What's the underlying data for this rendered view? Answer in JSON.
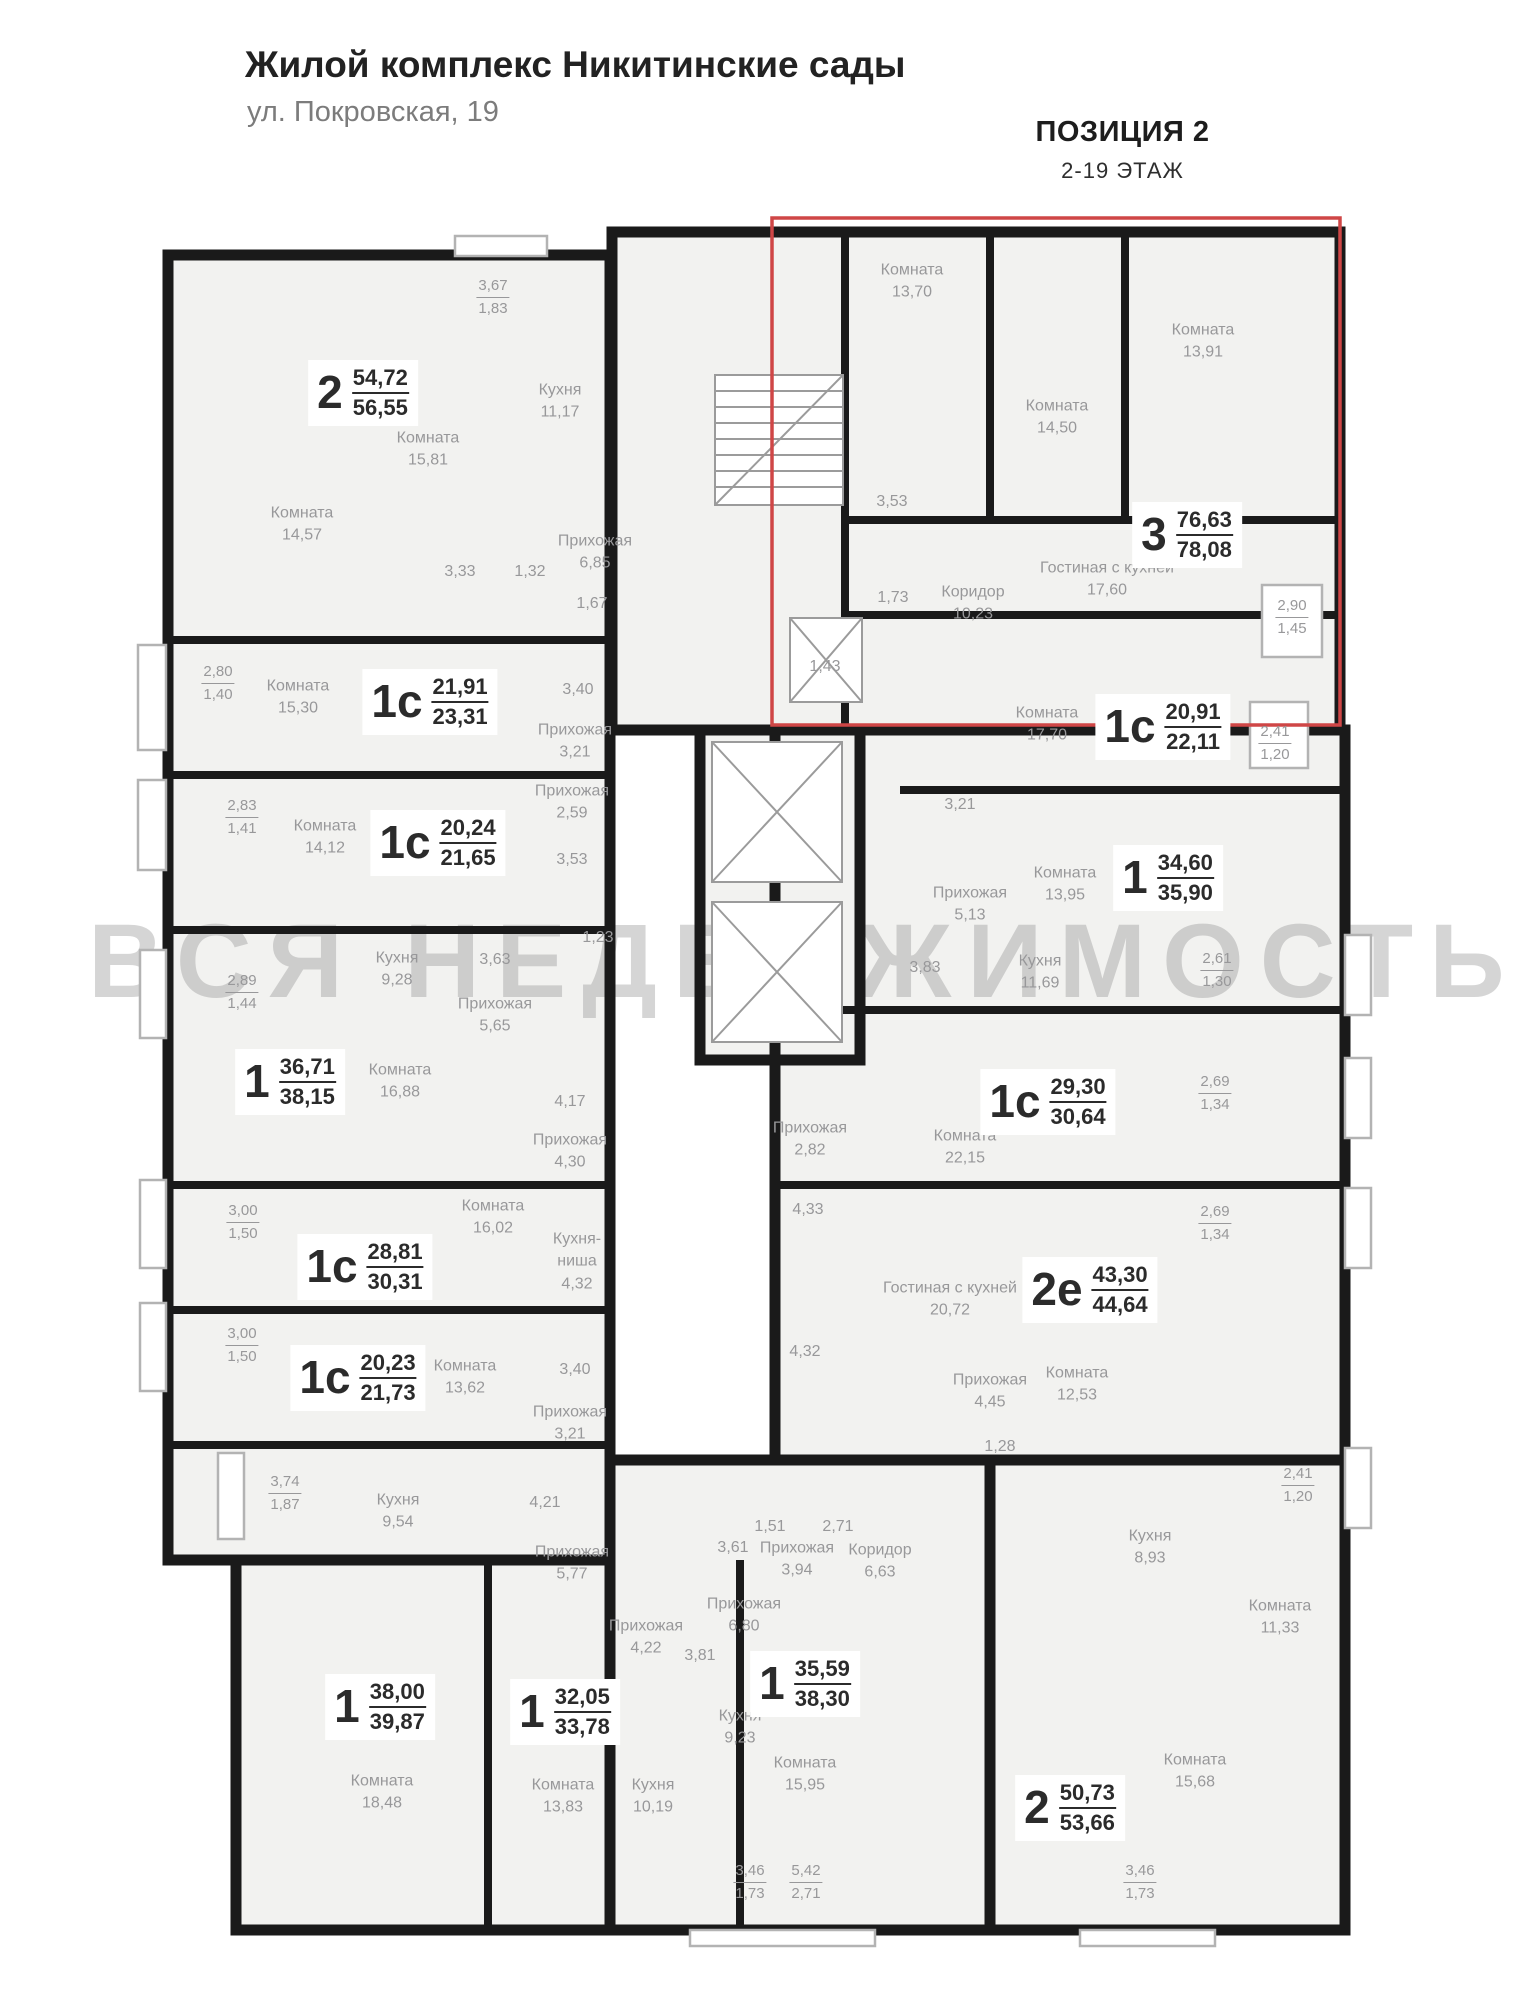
{
  "header": {
    "title": "Жилой комплекс Никитинские сады",
    "subtitle": "ул. Покровская, 19",
    "position_label": "ПОЗИЦИЯ 2",
    "floors_label": "2-19 ЭТАЖ"
  },
  "watermark": "ВСЯ НЕДВИЖИМОСТЬ",
  "colors": {
    "walls": "#1a1a1a",
    "room_fill": "#f2f2f0",
    "highlight": "#cf4646",
    "label_gray": "#98989a",
    "label_dark": "#2b2b2b",
    "watermark": "rgba(155,155,155,0.42)"
  },
  "highlight_box": {
    "x": 772,
    "y": 218,
    "w": 568,
    "h": 507
  },
  "apartments": [
    {
      "type": "2",
      "a": "54,72",
      "b": "56,55",
      "x": 363,
      "y": 393
    },
    {
      "type": "1с",
      "a": "21,91",
      "b": "23,31",
      "x": 430,
      "y": 702
    },
    {
      "type": "1с",
      "a": "20,24",
      "b": "21,65",
      "x": 438,
      "y": 843
    },
    {
      "type": "1",
      "a": "36,71",
      "b": "38,15",
      "x": 290,
      "y": 1082
    },
    {
      "type": "1с",
      "a": "28,81",
      "b": "30,31",
      "x": 365,
      "y": 1267
    },
    {
      "type": "1с",
      "a": "20,23",
      "b": "21,73",
      "x": 358,
      "y": 1378
    },
    {
      "type": "1",
      "a": "38,00",
      "b": "39,87",
      "x": 380,
      "y": 1707
    },
    {
      "type": "1",
      "a": "32,05",
      "b": "33,78",
      "x": 565,
      "y": 1712
    },
    {
      "type": "1",
      "a": "35,59",
      "b": "38,30",
      "x": 805,
      "y": 1684
    },
    {
      "type": "2",
      "a": "50,73",
      "b": "53,66",
      "x": 1070,
      "y": 1808
    },
    {
      "type": "3",
      "a": "76,63",
      "b": "78,08",
      "x": 1187,
      "y": 535
    },
    {
      "type": "1с",
      "a": "20,91",
      "b": "22,11",
      "x": 1163,
      "y": 727
    },
    {
      "type": "1",
      "a": "34,60",
      "b": "35,90",
      "x": 1168,
      "y": 878
    },
    {
      "type": "1с",
      "a": "29,30",
      "b": "30,64",
      "x": 1048,
      "y": 1102
    },
    {
      "type": "2е",
      "a": "43,30",
      "b": "44,64",
      "x": 1090,
      "y": 1290
    }
  ],
  "rooms": [
    {
      "name": "Комната",
      "area": "13,70",
      "x": 912,
      "y": 282
    },
    {
      "name": "Комната",
      "area": "14,50",
      "x": 1057,
      "y": 418
    },
    {
      "name": "Комната",
      "area": "13,91",
      "x": 1203,
      "y": 342
    },
    {
      "name": "Гостиная с кухней",
      "area": "17,60",
      "x": 1107,
      "y": 580
    },
    {
      "name": "Коридор",
      "area": "10,23",
      "x": 973,
      "y": 604
    },
    {
      "name": "",
      "area": "3,53",
      "x": 892,
      "y": 502
    },
    {
      "name": "",
      "area": "1,73",
      "x": 893,
      "y": 598
    },
    {
      "name": "",
      "area": "1,43",
      "x": 825,
      "y": 667
    },
    {
      "name": "Комната",
      "area": "17,70",
      "x": 1047,
      "y": 725
    },
    {
      "name": "Кухня",
      "area": "11,17",
      "x": 560,
      "y": 402
    },
    {
      "name": "Комната",
      "area": "15,81",
      "x": 428,
      "y": 450
    },
    {
      "name": "Комната",
      "area": "14,57",
      "x": 302,
      "y": 525
    },
    {
      "name": "Прихожая",
      "area": "6,85",
      "x": 595,
      "y": 553
    },
    {
      "name": "",
      "area": "3,33",
      "x": 460,
      "y": 572
    },
    {
      "name": "",
      "area": "1,32",
      "x": 530,
      "y": 572
    },
    {
      "name": "",
      "area": "1,67",
      "x": 592,
      "y": 604
    },
    {
      "name": "Комната",
      "area": "15,30",
      "x": 298,
      "y": 698
    },
    {
      "name": "",
      "area": "3,40",
      "x": 578,
      "y": 690
    },
    {
      "name": "Прихожая",
      "area": "3,21",
      "x": 575,
      "y": 742
    },
    {
      "name": "Комната",
      "area": "14,12",
      "x": 325,
      "y": 838
    },
    {
      "name": "Прихожая",
      "area": "2,59",
      "x": 572,
      "y": 803
    },
    {
      "name": "",
      "area": "3,53",
      "x": 572,
      "y": 860
    },
    {
      "name": "",
      "area": "1,23",
      "x": 598,
      "y": 938
    },
    {
      "name": "Кухня",
      "area": "9,28",
      "x": 397,
      "y": 970
    },
    {
      "name": "",
      "area": "3,63",
      "x": 495,
      "y": 960
    },
    {
      "name": "Прихожая",
      "area": "5,65",
      "x": 495,
      "y": 1016
    },
    {
      "name": "Комната",
      "area": "16,88",
      "x": 400,
      "y": 1082
    },
    {
      "name": "",
      "area": "4,17",
      "x": 570,
      "y": 1102
    },
    {
      "name": "Прихожая",
      "area": "4,30",
      "x": 570,
      "y": 1152
    },
    {
      "name": "Комната",
      "area": "16,02",
      "x": 493,
      "y": 1218
    },
    {
      "name": "Кухня-\nниша",
      "area": "4,32",
      "x": 577,
      "y": 1262
    },
    {
      "name": "Комната",
      "area": "13,62",
      "x": 465,
      "y": 1378
    },
    {
      "name": "",
      "area": "3,40",
      "x": 575,
      "y": 1370
    },
    {
      "name": "Прихожая",
      "area": "3,21",
      "x": 570,
      "y": 1424
    },
    {
      "name": "Кухня",
      "area": "9,54",
      "x": 398,
      "y": 1512
    },
    {
      "name": "",
      "area": "4,21",
      "x": 545,
      "y": 1503
    },
    {
      "name": "Прихожая",
      "area": "5,77",
      "x": 572,
      "y": 1564
    },
    {
      "name": "Комната",
      "area": "18,48",
      "x": 382,
      "y": 1793
    },
    {
      "name": "Комната",
      "area": "13,83",
      "x": 563,
      "y": 1797
    },
    {
      "name": "Прихожая",
      "area": "4,22",
      "x": 646,
      "y": 1638
    },
    {
      "name": "",
      "area": "3,81",
      "x": 700,
      "y": 1656
    },
    {
      "name": "Кухня",
      "area": "10,19",
      "x": 653,
      "y": 1797
    },
    {
      "name": "",
      "area": "3,61",
      "x": 733,
      "y": 1548
    },
    {
      "name": "Прихожая",
      "area": "6,80",
      "x": 744,
      "y": 1616
    },
    {
      "name": "Кухня",
      "area": "9,23",
      "x": 740,
      "y": 1728
    },
    {
      "name": "Комната",
      "area": "15,95",
      "x": 805,
      "y": 1775
    },
    {
      "name": "Прихожая",
      "area": "3,94",
      "x": 797,
      "y": 1560
    },
    {
      "name": "Коридор",
      "area": "6,63",
      "x": 880,
      "y": 1562
    },
    {
      "name": "",
      "area": "1,51",
      "x": 770,
      "y": 1527
    },
    {
      "name": "",
      "area": "2,71",
      "x": 838,
      "y": 1527
    },
    {
      "name": "Кухня",
      "area": "8,93",
      "x": 1150,
      "y": 1548
    },
    {
      "name": "Комната",
      "area": "11,33",
      "x": 1280,
      "y": 1618
    },
    {
      "name": "Комната",
      "area": "15,68",
      "x": 1195,
      "y": 1772
    },
    {
      "name": "Комната",
      "area": "13,95",
      "x": 1065,
      "y": 885
    },
    {
      "name": "Прихожая",
      "area": "5,13",
      "x": 970,
      "y": 905
    },
    {
      "name": "",
      "area": "3,83",
      "x": 925,
      "y": 968
    },
    {
      "name": "Кухня",
      "area": "11,69",
      "x": 1040,
      "y": 973
    },
    {
      "name": "",
      "area": "3,21",
      "x": 960,
      "y": 805
    },
    {
      "name": "Комната",
      "area": "22,15",
      "x": 965,
      "y": 1148
    },
    {
      "name": "Прихожая",
      "area": "2,82",
      "x": 810,
      "y": 1140
    },
    {
      "name": "",
      "area": "4,33",
      "x": 808,
      "y": 1210
    },
    {
      "name": "",
      "area": "4,32",
      "x": 805,
      "y": 1352
    },
    {
      "name": "Гостиная с кухней",
      "area": "20,72",
      "x": 950,
      "y": 1300
    },
    {
      "name": "Комната",
      "area": "12,53",
      "x": 1077,
      "y": 1385
    },
    {
      "name": "Прихожая",
      "area": "4,45",
      "x": 990,
      "y": 1392
    },
    {
      "name": "",
      "area": "1,28",
      "x": 1000,
      "y": 1447
    }
  ],
  "dimensions": [
    {
      "a": "3,67",
      "b": "1,83",
      "x": 493,
      "y": 297
    },
    {
      "a": "2,80",
      "b": "1,40",
      "x": 218,
      "y": 683
    },
    {
      "a": "2,83",
      "b": "1,41",
      "x": 242,
      "y": 817
    },
    {
      "a": "2,89",
      "b": "1,44",
      "x": 242,
      "y": 992
    },
    {
      "a": "3,00",
      "b": "1,50",
      "x": 243,
      "y": 1222
    },
    {
      "a": "3,00",
      "b": "1,50",
      "x": 242,
      "y": 1345
    },
    {
      "a": "3,74",
      "b": "1,87",
      "x": 285,
      "y": 1493
    },
    {
      "a": "2,90",
      "b": "1,45",
      "x": 1292,
      "y": 617
    },
    {
      "a": "2,41",
      "b": "1,20",
      "x": 1275,
      "y": 743
    },
    {
      "a": "2,61",
      "b": "1,30",
      "x": 1217,
      "y": 970
    },
    {
      "a": "2,69",
      "b": "1,34",
      "x": 1215,
      "y": 1093
    },
    {
      "a": "2,69",
      "b": "1,34",
      "x": 1215,
      "y": 1223
    },
    {
      "a": "2,41",
      "b": "1,20",
      "x": 1298,
      "y": 1485
    },
    {
      "a": "3,46",
      "b": "1,73",
      "x": 750,
      "y": 1882
    },
    {
      "a": "5,42",
      "b": "2,71",
      "x": 806,
      "y": 1882
    },
    {
      "a": "3,46",
      "b": "1,73",
      "x": 1140,
      "y": 1882
    }
  ]
}
